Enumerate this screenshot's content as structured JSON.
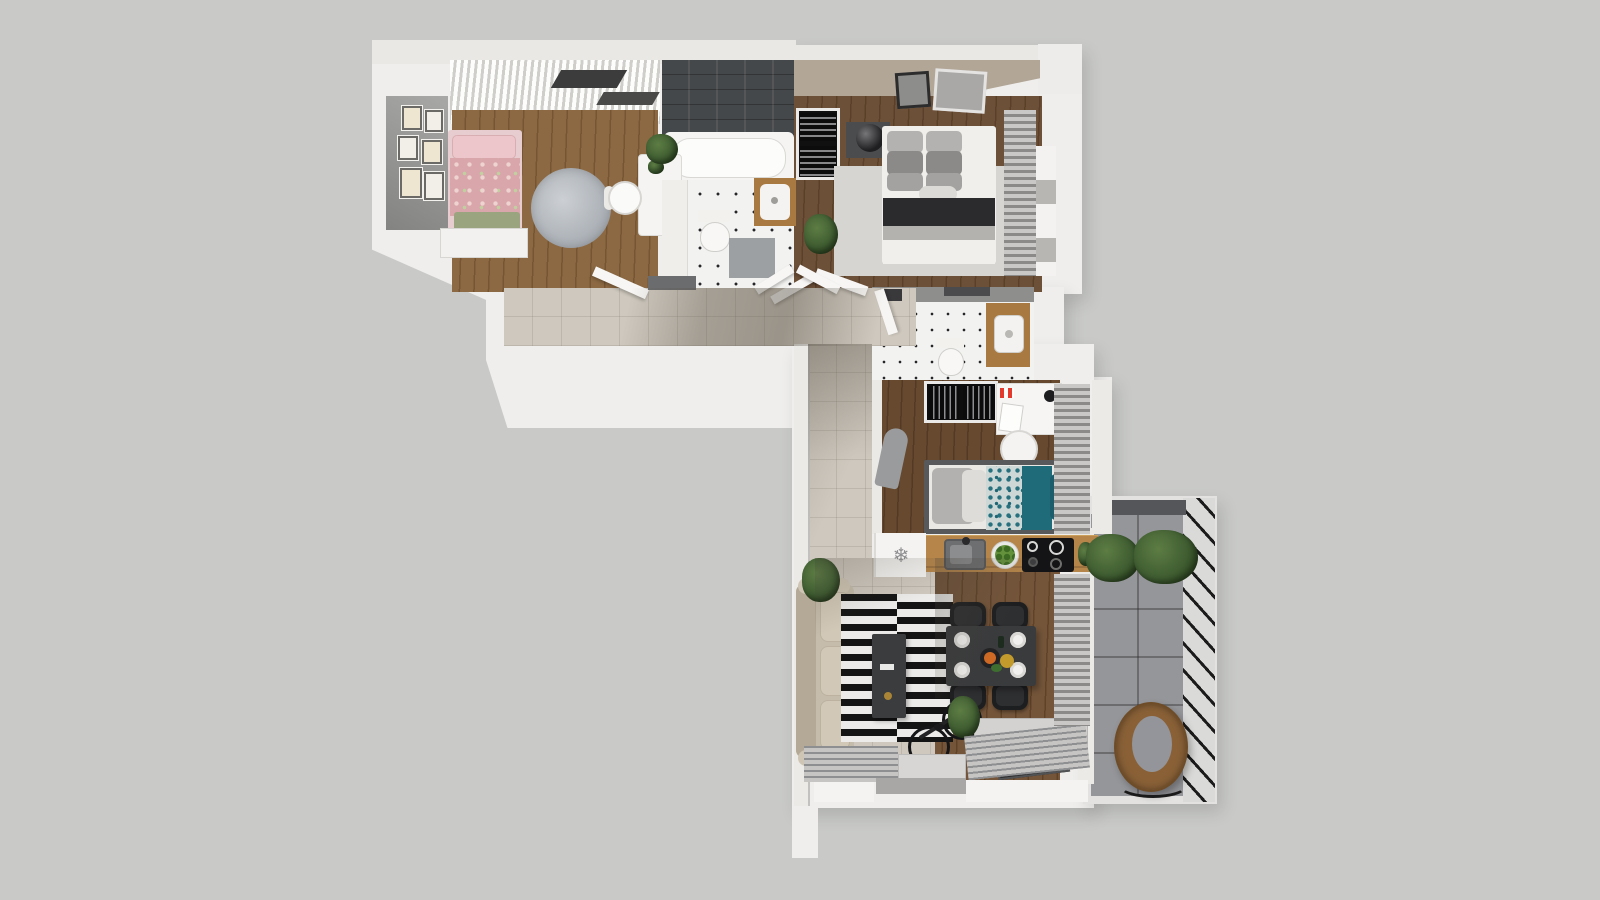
{
  "meta": {
    "title": "Top-down 3D apartment floor plan render",
    "type": "architectural-visualization",
    "view": "top-down axonometric"
  },
  "icons": {
    "fridge_snowflake": "❄"
  },
  "colors": {
    "bg": "#c9cac8",
    "wall": "#efeeec",
    "wallEdge": "#c2c1bf",
    "tile": "#cec8be",
    "woodLight": "#8c6943",
    "woodMid": "#6d5038",
    "woodDark": "#66492f",
    "woodLiving": "#74553a",
    "counterWood": "#b5854a",
    "vanityWood": "#a87940",
    "darkTile": "#45484a",
    "taupe": "#b2a697",
    "dotTile": "#f2f2f0",
    "dot": "#26262a",
    "pink": "#d8a6ab",
    "pinkLight": "#ecc6ca",
    "sageGreen": "#9aa57f",
    "teal": "#1f6b7a",
    "tealDeep": "#1c5d6c",
    "sofa": "#c6bcab",
    "rugWhite": "#ecebe9",
    "rugBlack": "#141414",
    "bedrugGray": "#d7d5d2",
    "fluffyRug": "#a9aeb4",
    "balconyTile": "#95969a",
    "railDark": "#1b1b1b",
    "rattan": "#8a6137",
    "plant": "#3f5d31",
    "plantDark": "#2c441f",
    "black": "#141416",
    "chairBlack": "#1d1e20",
    "grayFixture": "#9da0a2",
    "blindGray": "#8b8a88",
    "blindLight": "#c9c8c6"
  },
  "rooms": [
    {
      "id": "bedroom-1",
      "label": "bedroom-1",
      "furniture": [
        "pink-single-bed",
        "gallery-wall",
        "dresser",
        "round-rug",
        "desk",
        "chair",
        "plant",
        "curtains"
      ]
    },
    {
      "id": "bathroom",
      "label": "bathroom",
      "furniture": [
        "bathtub",
        "toilet",
        "vanity-sink",
        "bath-mat",
        "dark-tile-wall"
      ]
    },
    {
      "id": "bedroom-2",
      "label": "master-bedroom",
      "furniture": [
        "double-bed",
        "nightstand",
        "lamp",
        "open-wardrobe",
        "area-rug",
        "wall-art",
        "plant",
        "window-blinds"
      ]
    },
    {
      "id": "hallway",
      "label": "hallway",
      "furniture": [
        "doormat",
        "open-doors"
      ]
    },
    {
      "id": "wc",
      "label": "wc",
      "furniture": [
        "toilet",
        "vanity-sink",
        "towel-hooks"
      ]
    },
    {
      "id": "kids-room",
      "label": "kids-room",
      "furniture": [
        "teal-single-bed",
        "open-wardrobe",
        "desk",
        "chair",
        "ironing-board",
        "window-blinds"
      ]
    },
    {
      "id": "kitchen",
      "label": "kitchen",
      "furniture": [
        "fridge",
        "wood-counter",
        "sink",
        "cooktop",
        "fruit-bowl"
      ]
    },
    {
      "id": "living-dining",
      "label": "living-dining-room",
      "furniture": [
        "sofa",
        "striped-rug",
        "coffee-table",
        "dining-table",
        "four-chairs",
        "tv-bench",
        "tv",
        "bicycle",
        "plants",
        "radiator-vents"
      ]
    },
    {
      "id": "balcony",
      "label": "balcony",
      "furniture": [
        "hanging-egg-chair",
        "planters",
        "glass-railing"
      ]
    }
  ]
}
